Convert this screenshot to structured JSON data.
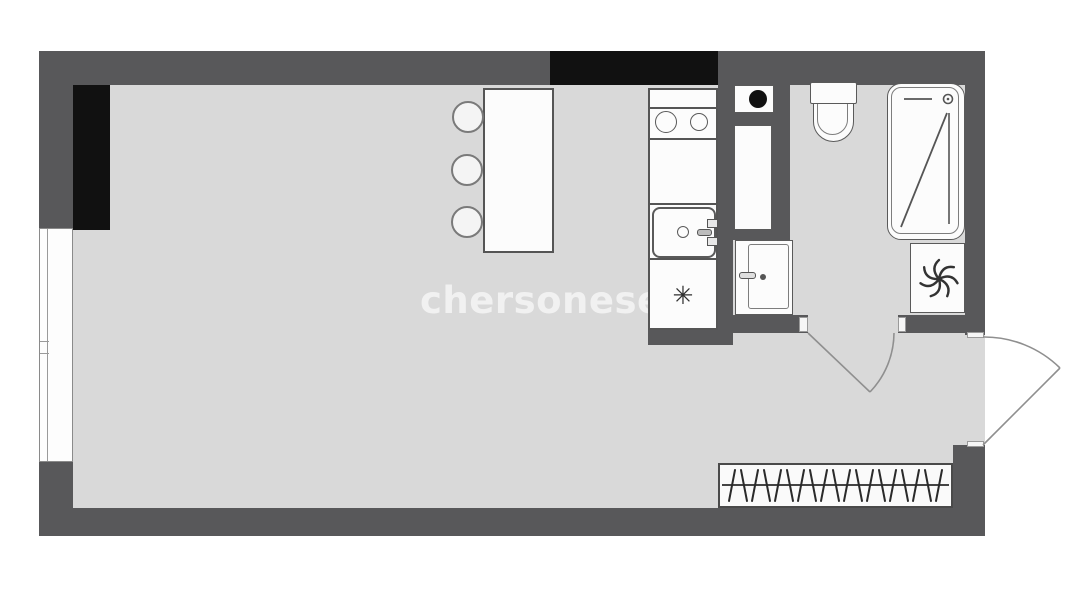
{
  "watermark": {
    "text": "chersonese"
  },
  "symbols": {
    "fridge_snowflake": "✳"
  },
  "colors": {
    "wall": "#58585a",
    "accent_black": "#111111",
    "floor": "#d9d9d9",
    "fixture_outline": "#555555",
    "fixture_fill": "#fcfcfc",
    "background": "#ffffff",
    "door_arc": "#8f8f8f",
    "watermark_text": "rgba(255,255,255,0.62)"
  },
  "icons": {
    "extractor_fan": "pinwheel-swirl",
    "vent_shaft": "black-dot",
    "shower_head": "small-circle-with-arm",
    "wardrobe_hangers": "slanted-strokes-on-rail",
    "fridge_marker": "six-point-asterisk"
  },
  "plan": {
    "type": "studio-apartment-floor-plan",
    "rooms": [
      "main-room",
      "kitchen-nook",
      "bathroom",
      "entry-hall"
    ],
    "fixtures": [
      "bar-table",
      "bar-stools-x3",
      "cooktop-2-burner",
      "kitchen-sink",
      "refrigerator-cell",
      "vent-shaft",
      "duct-cabinet",
      "storage-cabinet",
      "toilet",
      "shower-cabin",
      "extractor-fan-unit",
      "wardrobe-with-hangers",
      "window",
      "entry-door",
      "bathroom-door"
    ]
  }
}
